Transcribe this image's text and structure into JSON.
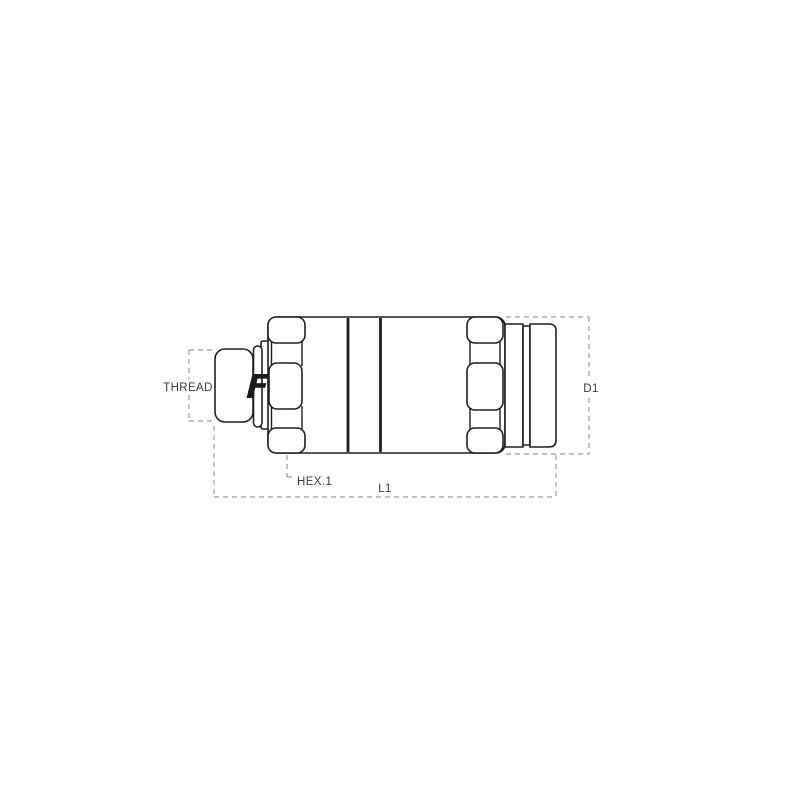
{
  "figure": {
    "type": "technical-drawing",
    "subject": "flat-face quick coupling, male threaded end, side view",
    "logo_letter": "F",
    "labels": {
      "thread": "THREAD",
      "hex": "HEX.1",
      "length": "L1",
      "diameter": "D1"
    },
    "colors": {
      "background": "#ffffff",
      "outline": "#1f1f1f",
      "dimension": "#9c9c9c",
      "label_text": "#3a3a3a",
      "logo": "#1a1a1a"
    }
  }
}
